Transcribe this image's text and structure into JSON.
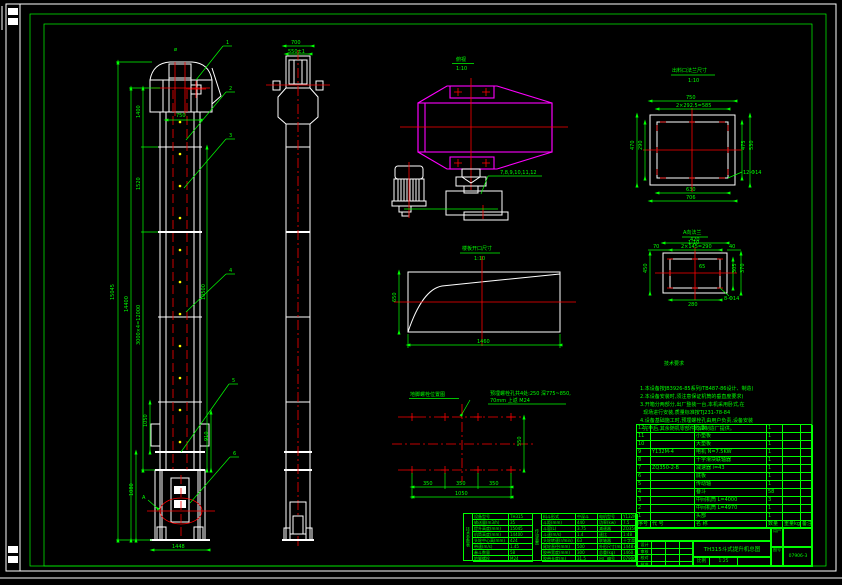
{
  "front": {
    "balloons": [
      "1",
      "2",
      "3",
      "4",
      "5",
      "6"
    ],
    "dia": "ø",
    "view_arrow": "A",
    "d_total": "15045",
    "d_mid": "14400",
    "d_sections": "3000×4=12000",
    "d_top": "1400",
    "d_second": "1520",
    "d_head_w": "750",
    "d_right": "10500",
    "d_boot1": "1050",
    "d_boot2": "1080",
    "d_boot_r": "910",
    "d_base": "1448"
  },
  "side": {
    "d_w": "700",
    "d_inner": "550±1"
  },
  "head_detail": {
    "title": "俯视",
    "scale": "1:10",
    "leader": "7,8,9,10,11,12"
  },
  "opening": {
    "title": "楼板开口尺寸",
    "scale": "1:10",
    "d_w": "1460",
    "d_h": "650"
  },
  "anchor": {
    "title": "地脚螺栓位置图",
    "note1": "预埋螺栓孔共4处:250 深775~850,",
    "note2": "70mm 上返 M24",
    "d1": "350",
    "d2": "350",
    "d3": "350",
    "d_total": "1050",
    "d_h": "550"
  },
  "flange_b": {
    "title": "出料口法兰尺寸",
    "scale": "1:10",
    "d_top": "750",
    "d_top2": "2×292.5=585",
    "d_l1": "470",
    "d_l2": "290",
    "d_r1": "475",
    "d_r2": "530",
    "d_b1": "630",
    "d_b2": "706",
    "leader": "12-Φ14"
  },
  "flange_a": {
    "title": "A向法兰",
    "scale": "1:10",
    "d_top": "420",
    "d_70": "70",
    "d_mid": "2×145=290",
    "d_40": "40",
    "d_l": "450",
    "d_r1": "305",
    "d_r2": "370",
    "d_b": "280",
    "d_c": "65",
    "leader": "8-Φ14"
  },
  "notes": {
    "title": "技术要求",
    "lines": [
      "1.本设备按JB3926-85系列/TB487-86设计、制造)",
      "2.本设备安装时,须注意保证机筒的垂直度要求)",
      "3.开箱分两部分,出厂整装一台,本机采用卧式,在",
      "  现场进行安装,质量标准按TJ231-78-84",
      "4.设备基础施工时,预埋螺栓孔由用户负责,设备安装",
      "  完毕后,其余随机零部件均由制造厂提供。"
    ]
  },
  "bom": {
    "headers": [
      "序号",
      "代  号",
      "名    称",
      "数量",
      "重量kg",
      "备注"
    ],
    "rows": [
      [
        "12",
        "",
        "压板",
        "1",
        "",
        ""
      ],
      [
        "11",
        "",
        "小垫板",
        "1",
        "",
        ""
      ],
      [
        "10",
        "",
        "大垫板",
        "1",
        "",
        ""
      ],
      [
        "9",
        "Y132M-4",
        "电机 N=7.5KW",
        "1",
        "",
        ""
      ],
      [
        "8",
        "",
        "十字滑块联轴器",
        "1",
        "",
        ""
      ],
      [
        "7",
        "ZQ350-2-B",
        "减速器 i=43",
        "1",
        "",
        ""
      ],
      [
        "6",
        "",
        "底板",
        "1",
        "",
        ""
      ],
      [
        "5",
        "",
        "传动轴",
        "1",
        "",
        ""
      ],
      [
        "4",
        "",
        "畚斗",
        "58",
        "",
        ""
      ],
      [
        "3",
        "",
        "中间机筒 L=4000",
        "3",
        "",
        ""
      ],
      [
        "2",
        "",
        "中间机筒 L=4970",
        "1",
        "",
        ""
      ],
      [
        "1",
        "",
        "头部",
        "1",
        "",
        ""
      ]
    ]
  },
  "params": {
    "side_label": "技术参数表",
    "side_label2": "传动装置",
    "rows": [
      {
        "l1": "设备型号",
        "v1": "TH315",
        "l2": "料斗形式",
        "v2": "中深斗",
        "l3": "电机型号",
        "v3": "Y132M-4"
      },
      {
        "l1": "输送量(m3/h)",
        "v1": "35",
        "l2": "斗距(mm)",
        "v2": "440",
        "l3": "功率(kw)",
        "v3": "7.5"
      },
      {
        "l1": "提升高度(mm)",
        "v1": "15045",
        "l2": "斗容(L)",
        "v2": "3.75",
        "l3": "减速器",
        "v3": "ZQ350-2-B"
      },
      {
        "l1": "机筒高度(mm)",
        "v1": "14400",
        "l2": "斗速(m/s)",
        "v2": "1.4",
        "l3": "速比",
        "v3": "1:48"
      },
      {
        "l1": "头轮中心高(mm)",
        "v1": "424",
        "l2": "头轮转速(r/min)",
        "v2": "63",
        "l3": "联轴器",
        "v3": "十字滑块"
      },
      {
        "l1": "带速(m/s)",
        "v1": "1.45",
        "l2": "尾轮直径(mm)",
        "v2": "500",
        "l3": "外形尺寸(mm)",
        "v3": "1448×1264"
      },
      {
        "l1": "畚斗数量",
        "v1": "58",
        "l2": "胶带宽度(mm)",
        "v2": "300",
        "l3": "总重(kg)",
        "v3": "1460"
      },
      {
        "l1": "地脚螺栓",
        "v1": "M24",
        "l2": "胶带长度(m)",
        "v2": "31.5",
        "l3": "出厂编号",
        "v3": "07906"
      }
    ]
  },
  "titleblock": {
    "title": "TH315斗式提升机总图",
    "scale_label": "比例",
    "scale_value": "1:25",
    "weight_label": "",
    "right_top_label": "用户",
    "right_bottom_label": "图号",
    "drawing_no": "07906-3",
    "sign_rows": [
      "设计",
      "审核",
      "校对",
      "批准"
    ]
  }
}
